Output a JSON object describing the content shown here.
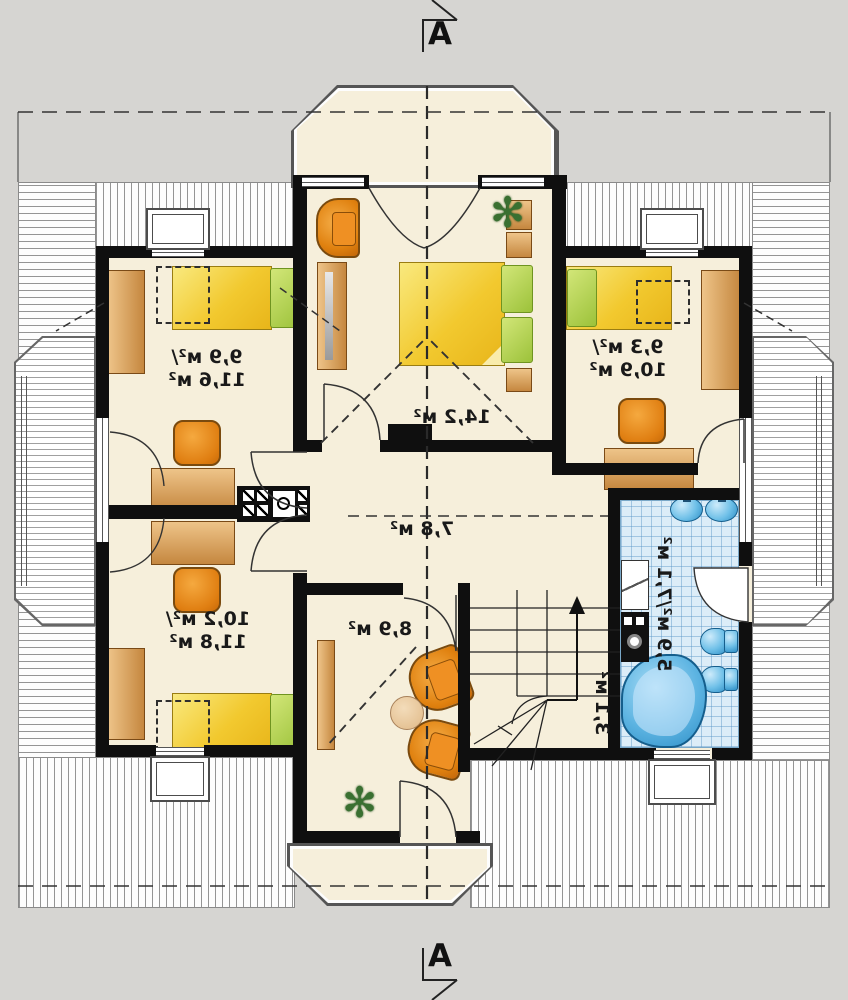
{
  "section_markers": {
    "top": "A",
    "bottom": "A"
  },
  "rooms": {
    "bedroom_top_left": {
      "area_line1": "9,9 м²/",
      "area_line2": "11,6 м²"
    },
    "master_bedroom": {
      "area": "14,2 м²"
    },
    "bedroom_right": {
      "area_line1": "9,3 м²/",
      "area_line2": "10,9 м²"
    },
    "hall": {
      "area": "7,8 м²"
    },
    "bedroom_bottom_left": {
      "area_line1": "10,2 м²/",
      "area_line2": "11,8 м²"
    },
    "sitting_room": {
      "area": "8,9 м²"
    },
    "bathroom": {
      "area": "5,9 м²/7,1 м²"
    },
    "staircase": {
      "area": "3,1 м²"
    }
  },
  "icons": {
    "plant": "✻"
  },
  "colors": {
    "wall": "#0f0f0f",
    "floor": "#f6efdb",
    "background": "#d6d5d2",
    "wood": "#cf9149",
    "bed": "#f2c92f",
    "pillow": "#a6c93e",
    "chair": "#e07f12",
    "bathroom_tile": "#dcedf8",
    "fixture": "#55b1e0",
    "label": "#191919"
  }
}
